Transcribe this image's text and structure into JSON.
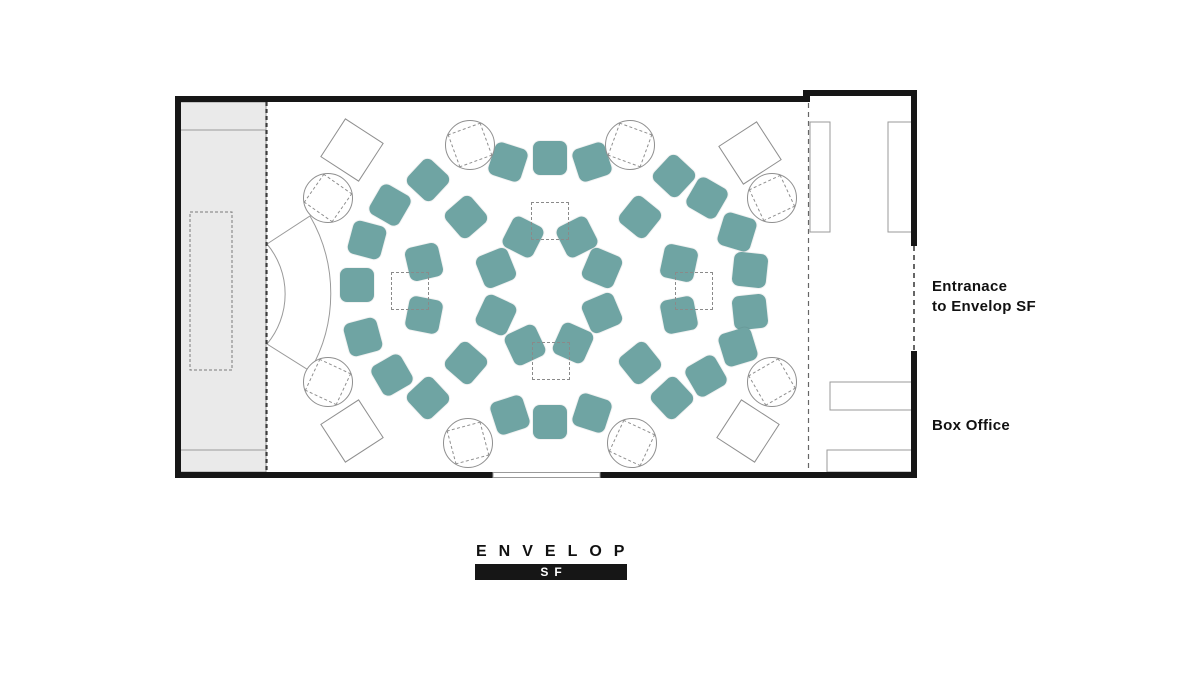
{
  "colors": {
    "seat": "#6FA4A3",
    "wall": "#161616",
    "stage": "#EAEAEA",
    "outline": "#8F8F8F",
    "text": "#111111"
  },
  "labels": {
    "entrance_line1": "Entranace",
    "entrance_line2": "to Envelop SF",
    "box_office": "Box Office"
  },
  "logo": {
    "name": "ENVELOP",
    "sub": "SF"
  },
  "floor_plan": {
    "center": {
      "x": 550,
      "y": 290
    },
    "seat_size": 34,
    "marker_size": 36,
    "table_diameter": 48,
    "table_square": 33,
    "diamond_size": 44,
    "seats": [
      {
        "x": 523,
        "y": 237,
        "rot": 27
      },
      {
        "x": 577,
        "y": 237,
        "rot": -27
      },
      {
        "x": 602,
        "y": 268,
        "rot": 23
      },
      {
        "x": 602,
        "y": 313,
        "rot": -23
      },
      {
        "x": 573,
        "y": 343,
        "rot": 24
      },
      {
        "x": 525,
        "y": 345,
        "rot": -25
      },
      {
        "x": 496,
        "y": 315,
        "rot": 25
      },
      {
        "x": 496,
        "y": 268,
        "rot": -22
      },
      {
        "x": 466,
        "y": 217,
        "rot": 49
      },
      {
        "x": 424,
        "y": 262,
        "rot": -13
      },
      {
        "x": 424,
        "y": 315,
        "rot": 11
      },
      {
        "x": 466,
        "y": 363,
        "rot": -49
      },
      {
        "x": 640,
        "y": 217,
        "rot": 39
      },
      {
        "x": 679,
        "y": 263,
        "rot": 12
      },
      {
        "x": 679,
        "y": 315,
        "rot": -11
      },
      {
        "x": 640,
        "y": 363,
        "rot": -39
      },
      {
        "x": 508,
        "y": 162,
        "rot": 18
      },
      {
        "x": 550,
        "y": 158,
        "rot": 0
      },
      {
        "x": 592,
        "y": 162,
        "rot": -18
      },
      {
        "x": 674,
        "y": 176,
        "rot": 43
      },
      {
        "x": 707,
        "y": 198,
        "rot": 30
      },
      {
        "x": 737,
        "y": 232,
        "rot": 17
      },
      {
        "x": 750,
        "y": 270,
        "rot": 6
      },
      {
        "x": 750,
        "y": 312,
        "rot": -6
      },
      {
        "x": 738,
        "y": 347,
        "rot": -17
      },
      {
        "x": 706,
        "y": 376,
        "rot": -30
      },
      {
        "x": 672,
        "y": 398,
        "rot": -43
      },
      {
        "x": 592,
        "y": 413,
        "rot": 18
      },
      {
        "x": 550,
        "y": 422,
        "rot": 0
      },
      {
        "x": 510,
        "y": 415,
        "rot": -18
      },
      {
        "x": 428,
        "y": 398,
        "rot": -43
      },
      {
        "x": 392,
        "y": 375,
        "rot": -30
      },
      {
        "x": 363,
        "y": 337,
        "rot": -15
      },
      {
        "x": 357,
        "y": 285,
        "rot": 0
      },
      {
        "x": 367,
        "y": 240,
        "rot": 15
      },
      {
        "x": 390,
        "y": 205,
        "rot": 30
      },
      {
        "x": 428,
        "y": 180,
        "rot": 43
      }
    ],
    "tech_markers": [
      {
        "x": 550,
        "y": 221
      },
      {
        "x": 551,
        "y": 361
      },
      {
        "x": 410,
        "y": 291
      },
      {
        "x": 694,
        "y": 291
      }
    ],
    "round_tables": [
      {
        "x": 470,
        "y": 145,
        "rot": -20
      },
      {
        "x": 630,
        "y": 145,
        "rot": 20
      },
      {
        "x": 328,
        "y": 198,
        "rot": 35
      },
      {
        "x": 772,
        "y": 198,
        "rot": -25
      },
      {
        "x": 328,
        "y": 382,
        "rot": 25
      },
      {
        "x": 772,
        "y": 382,
        "rot": -30
      },
      {
        "x": 468,
        "y": 443,
        "rot": -15
      },
      {
        "x": 632,
        "y": 443,
        "rot": 25
      }
    ],
    "corner_tables": [
      {
        "x": 352,
        "y": 150,
        "rot": 33
      },
      {
        "x": 750,
        "y": 153,
        "rot": -33
      },
      {
        "x": 352,
        "y": 431,
        "rot": -33
      },
      {
        "x": 748,
        "y": 431,
        "rot": 33
      }
    ]
  }
}
